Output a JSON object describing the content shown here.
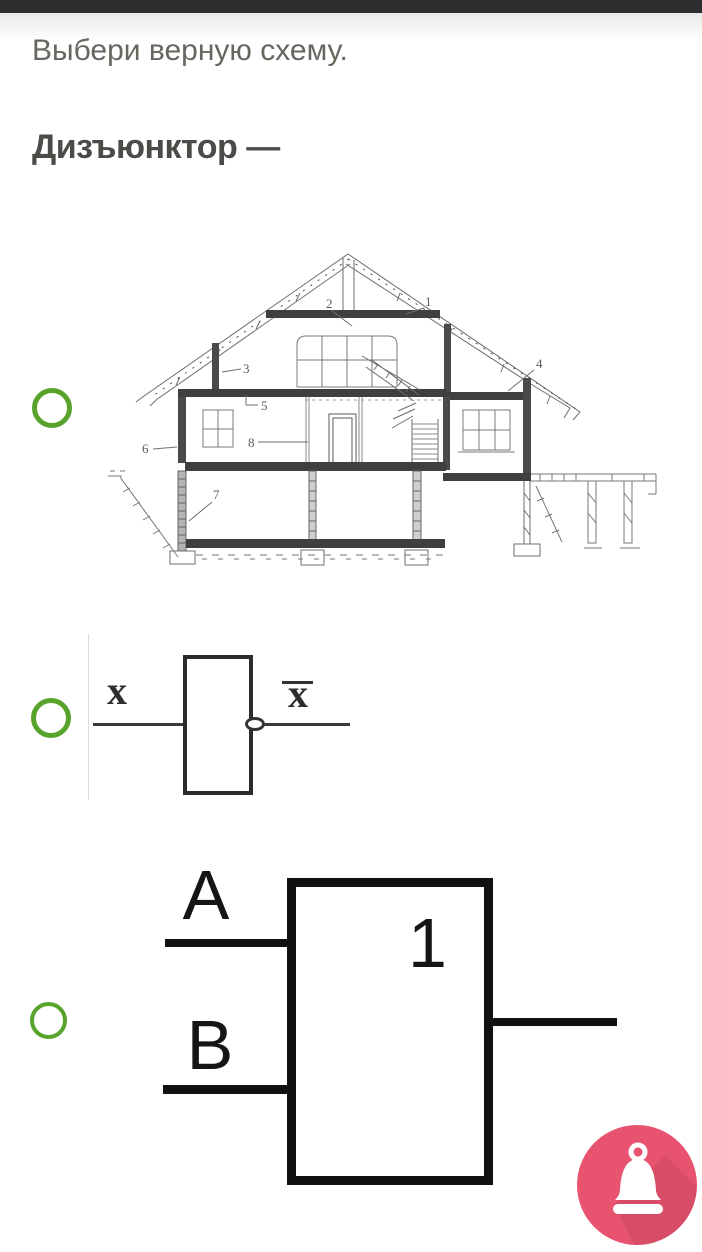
{
  "question": {
    "prompt": "Выбери верную схему.",
    "term": "Дизъюнктор —"
  },
  "colors": {
    "radio_green": "#58a32c",
    "bell_pink": "#e8536f",
    "top_bar": "#2d2e30",
    "gate_stroke": "#111111"
  },
  "options": [
    {
      "id": "house-blueprint",
      "selected": false,
      "description": "house-cross-section-drawing",
      "callouts": [
        "1",
        "2",
        "3",
        "4",
        "5",
        "6",
        "7",
        "8"
      ]
    },
    {
      "id": "not-gate",
      "selected": false,
      "input_label": "x",
      "output_label": "x̄",
      "output_base": "x"
    },
    {
      "id": "or-gate",
      "selected": false,
      "input_a": "A",
      "input_b": "B",
      "symbol": "1"
    }
  ],
  "bell": {
    "icon": "bell-icon"
  }
}
